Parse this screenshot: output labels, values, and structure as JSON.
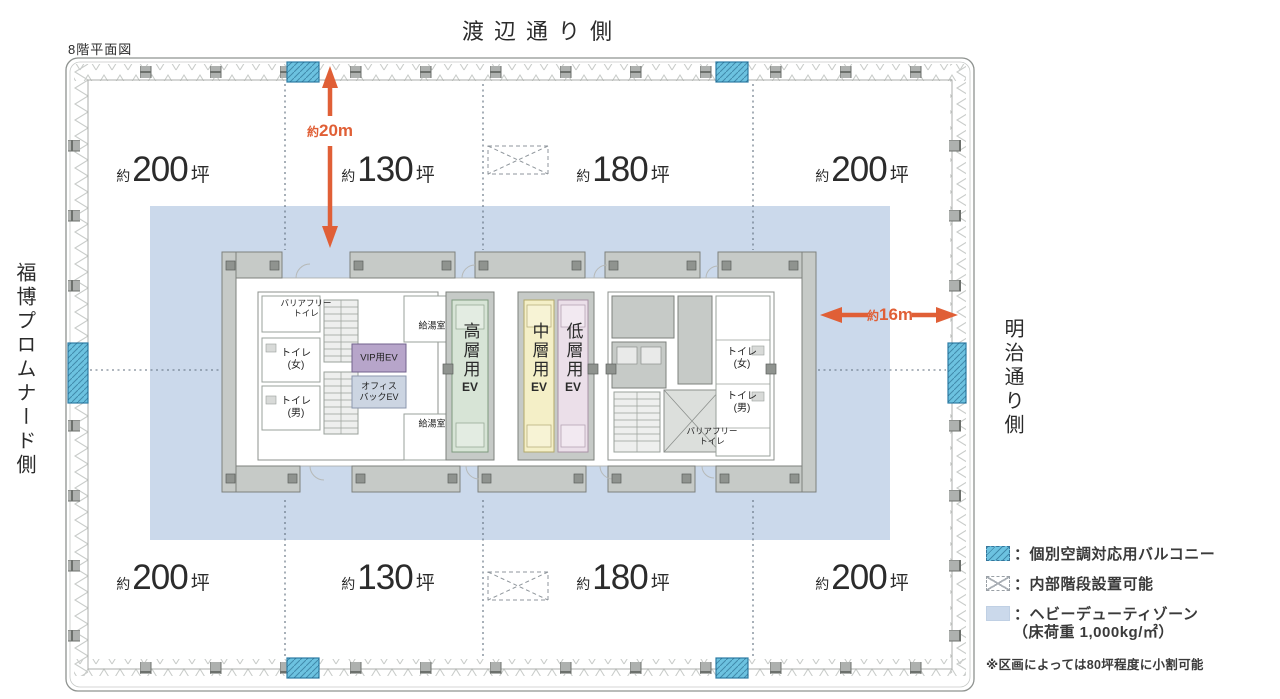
{
  "title": "8階平面図",
  "streets": {
    "top": "渡辺通り側",
    "left": "福博プロムナード側",
    "right": "明治通り側"
  },
  "areas": {
    "prefix": "約",
    "unit": "坪",
    "top": [
      "200",
      "130",
      "180",
      "200"
    ],
    "bottom": [
      "200",
      "130",
      "180",
      "200"
    ]
  },
  "dimensions": {
    "vertical": {
      "prefix": "約",
      "value": "20m"
    },
    "horizontal": {
      "prefix": "約",
      "value": "16m"
    }
  },
  "core": {
    "barrier_free_toilet": {
      "line1": "バリアフリー",
      "line2": "トイレ"
    },
    "toilet_women": {
      "line1": "トイレ",
      "line2": "(女)"
    },
    "toilet_men": {
      "line1": "トイレ",
      "line2": "(男)"
    },
    "vip_ev": "VIP用EV",
    "office_back_ev": {
      "line1": "オフィス",
      "line2": "バックEV"
    },
    "pantry": "給湯室",
    "high_ev": {
      "kanji": "高層用",
      "suffix": "EV"
    },
    "mid_ev": {
      "kanji": "中層用",
      "suffix": "EV"
    },
    "low_ev": {
      "kanji": "低層用",
      "suffix": "EV"
    }
  },
  "legend": {
    "balcony_label": "：個別空調対応用バルコニー",
    "stairs_label": "：内部階段設置可能",
    "heavy_label": "：ヘビーデューティゾーン",
    "heavy_label2": "（床荷重 1,000kg/㎡）",
    "note": "※区画によっては80坪程度に小割可能"
  },
  "colors": {
    "arrow": "#E05F36",
    "balcony": "#6CC2E0",
    "heavy_zone": "#CBD9EB",
    "vip_ev": "#B7A5CA",
    "office_back_ev": "#CCD5E2",
    "high_ev": "#D7E4D6",
    "mid_ev": "#F4EFC7",
    "low_ev": "#EBDFE9",
    "core_gray": "#C6CAC7"
  }
}
